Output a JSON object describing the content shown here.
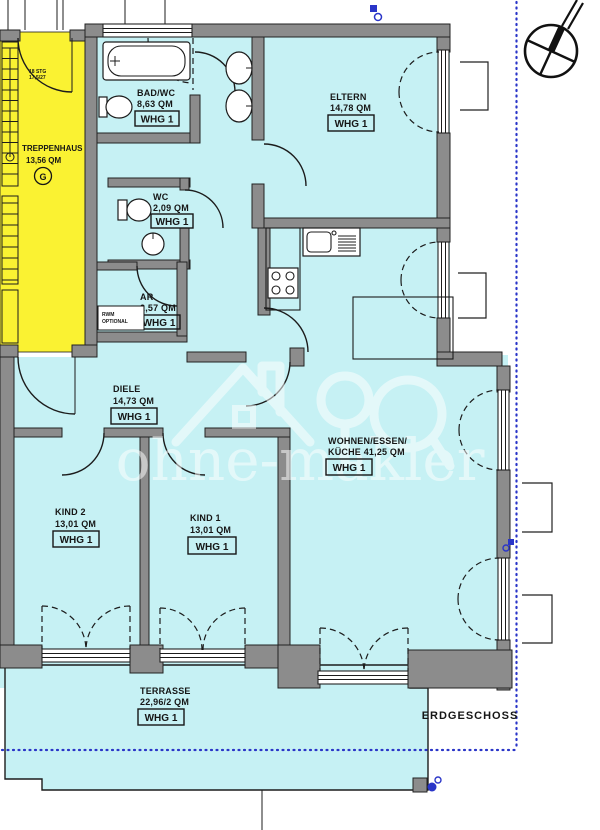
{
  "plan": {
    "floor_label": "ERDGESCHOSS",
    "watermark": "ohne-makler",
    "rooms": {
      "treppenhaus": {
        "name": "TREPPENHAUS",
        "area": "13,56 QM",
        "marker": "G",
        "stair_note_1": "18 STG",
        "stair_note_2": "17,5/27"
      },
      "bad": {
        "name": "BAD/WC",
        "area": "8,63 QM",
        "whg": "WHG 1"
      },
      "wc": {
        "name": "WC",
        "area": "2,09 QM",
        "whg": "WHG 1"
      },
      "ar": {
        "name": "AR",
        "area": "2,57 QM",
        "whg": "WHG 1",
        "note_1": "RWM",
        "note_2": "OPTIONAL"
      },
      "eltern": {
        "name": "ELTERN",
        "area": "14,78 QM",
        "whg": "WHG 1"
      },
      "diele": {
        "name": "DIELE",
        "area": "14,73 QM",
        "whg": "WHG 1"
      },
      "kind2": {
        "name": "KIND 2",
        "area": "13,01 QM",
        "whg": "WHG 1"
      },
      "kind1": {
        "name": "KIND 1",
        "area": "13,01 QM",
        "whg": "WHG 1"
      },
      "wohnen": {
        "name_1": "WOHNEN/ESSEN/",
        "name_2": "KÜCHE 41,25 QM",
        "whg": "WHG 1"
      },
      "terrasse": {
        "name": "TERRASSE",
        "area": "22,96/2 QM",
        "whg": "WHG 1"
      }
    },
    "colors": {
      "room_fill": "#c6f1f4",
      "stair_fill": "#faf232",
      "wall_fill": "#8c8c8c",
      "boundary_blue": "#2a35c8",
      "line": "#1c1c1c",
      "watermark": "#ffffff"
    }
  }
}
